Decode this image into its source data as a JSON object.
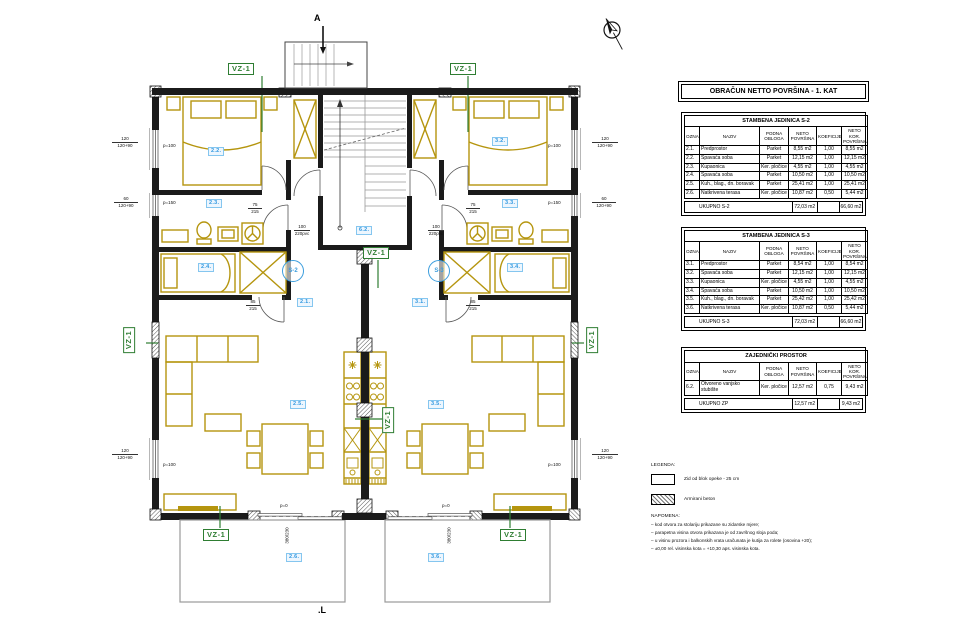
{
  "title_block": {
    "main_title": "OBRAČUN NETTO POVRŠINA - 1. KAT"
  },
  "columns": [
    "OZNAKA",
    "NAZIV",
    "PODNA OBLOGA",
    "NETO POVRŠINA",
    "KOEFICIJENT",
    "NETO KOR. POVRŠINA"
  ],
  "unit_s2": {
    "title": "STAMBENA JEDINICA S-2",
    "rows": [
      [
        "2.1.",
        "Predprostor",
        "Parket",
        "8,55 m2",
        "1,00",
        "8,55 m2"
      ],
      [
        "2.2.",
        "Spavaća soba",
        "Parket",
        "12,15 m2",
        "1,00",
        "12,15 m2"
      ],
      [
        "2.3.",
        "Kupaonica",
        "Ker. pločice",
        "4,55 m2",
        "1,00",
        "4,55 m2"
      ],
      [
        "2.4.",
        "Spavaća soba",
        "Parket",
        "10,50 m2",
        "1,00",
        "10,50 m2"
      ],
      [
        "2.5.",
        "Kuh., blag., dn. boravak",
        "Parket",
        "25,41 m2",
        "1,00",
        "25,41 m2"
      ],
      [
        "2.6.",
        "Natkrivena terasa",
        "Ker. pločice",
        "10,87 m2",
        "0,50",
        "5,44 m2"
      ]
    ],
    "total_label": "UKUPNO S-2",
    "total_neto": "72,03 m2",
    "total_koef": "",
    "total_kor": "66,60 m2"
  },
  "unit_s3": {
    "title": "STAMBENA JEDINICA S-3",
    "rows": [
      [
        "3.1.",
        "Predprostor",
        "Parket",
        "8,54 m2",
        "1,00",
        "8,54 m2"
      ],
      [
        "3.2.",
        "Spavaća soba",
        "Parket",
        "12,15 m2",
        "1,00",
        "12,15 m2"
      ],
      [
        "3.3.",
        "Kupaonica",
        "Ker. pločice",
        "4,55 m2",
        "1,00",
        "4,55 m2"
      ],
      [
        "3.4.",
        "Spavaća soba",
        "Parket",
        "10,50 m2",
        "1,00",
        "10,50 m2"
      ],
      [
        "3.5.",
        "Kuh., blag., dn. boravak",
        "Parket",
        "25,42 m2",
        "1,00",
        "25,42 m2"
      ],
      [
        "3.6.",
        "Natkrivena terasa",
        "Ker. pločice",
        "10,87 m2",
        "0,50",
        "5,44 m2"
      ]
    ],
    "total_label": "UKUPNO S-3",
    "total_neto": "72,03 m2",
    "total_koef": "",
    "total_kor": "66,60 m2"
  },
  "zp": {
    "title": "ZAJEDNIČKI PROSTOR",
    "rows": [
      [
        "6.2.",
        "Otvoreno vanjsko stubište",
        "Ker. pločice",
        "12,57 m2",
        "0,75",
        "9,43 m2"
      ]
    ],
    "total_label": "UKUPNO ZP",
    "total_neto": "12,57 m2",
    "total_koef": "",
    "total_kor": "9,43 m2"
  },
  "legend": {
    "title": "LEGENDA:",
    "wall_label": "Zid od blok opeke - 25 cm",
    "concrete_label": "Armirani beton"
  },
  "notes": {
    "title": "NAPOMENA:",
    "lines": [
      "–  kod otvora za stolariju prikazane su zidarske mjere;",
      "–  parapetna visina otvora prikazana je od završnog sloja poda;",
      "–  u visinu prozora i balkonskih vrata uračunata je kutija za rolete (osovina +20);",
      "–  ±0,00 rel. visinska kota  =  +10,30 aps. visinska kota."
    ]
  },
  "plan": {
    "marks": {
      "section_top": "A",
      "section_bottom": ".L"
    },
    "vz": "VZ-1",
    "s2_badge": "S-2",
    "s3_badge": "S-3",
    "rooms": {
      "r21": "2.1.",
      "r22": "2.2.",
      "r23": "2.3.",
      "r24": "2.4.",
      "r25": "2.5.",
      "r26": "2.6.",
      "r31": "3.1.",
      "r32": "3.2.",
      "r33": "3.3.",
      "r34": "3.4.",
      "r35": "3.5.",
      "r36": "3.6.",
      "r62": "6.2."
    },
    "dims": {
      "w120": "120",
      "w120p": "120+90",
      "w60": "60",
      "w60p": "120+90",
      "p100": "p=100",
      "p150": "p=150",
      "p0": "p=0",
      "slide": "380/230",
      "d75": "75",
      "d85": "85",
      "d215": "215",
      "d100": "100",
      "d220": "220",
      "pvc": "pvc"
    }
  }
}
